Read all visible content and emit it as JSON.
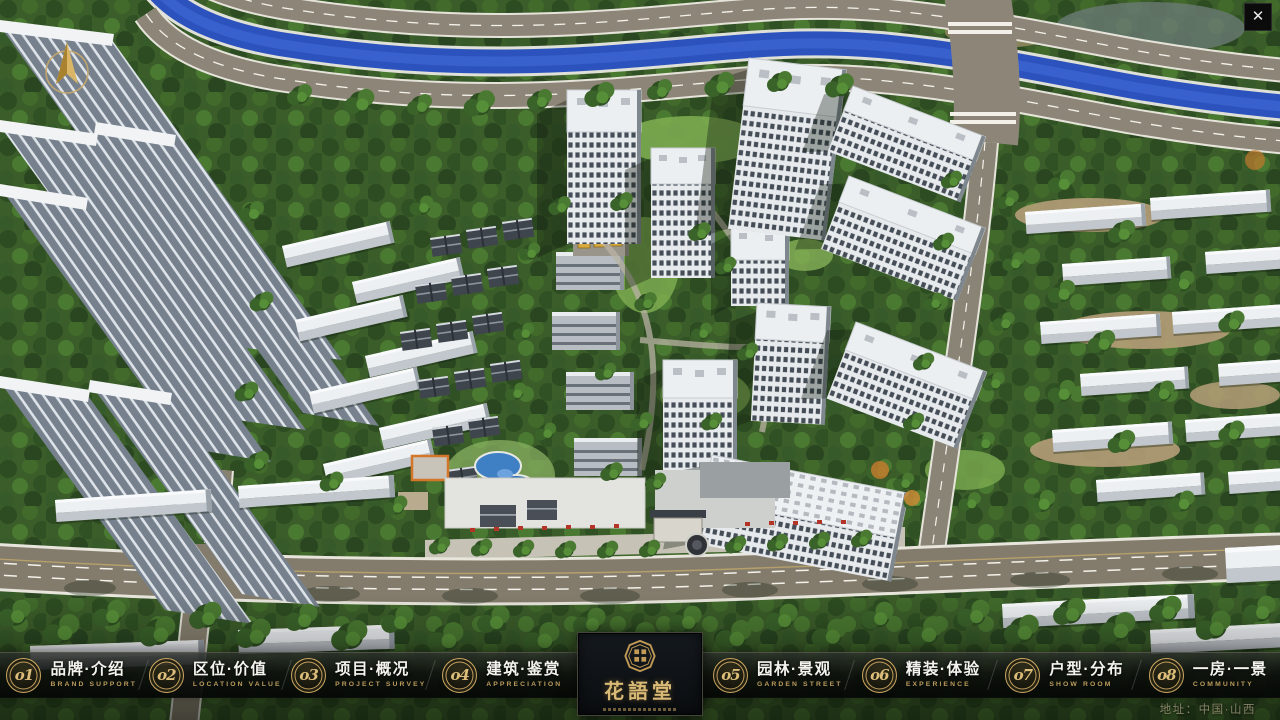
{
  "window": {
    "close": "✕"
  },
  "navbar": {
    "items": [
      {
        "number": "o1",
        "label": "品牌·介绍",
        "caption": "BRAND SUPPORT"
      },
      {
        "number": "o2",
        "label": "区位·价值",
        "caption": "LOCATION VALUE"
      },
      {
        "number": "o3",
        "label": "项目·概况",
        "caption": "PROJECT SURVEY"
      },
      {
        "number": "o4",
        "label": "建筑·鉴赏",
        "caption": "APPRECIATION"
      },
      {
        "number": "o5",
        "label": "园林·景观",
        "caption": "GARDEN STREET"
      },
      {
        "number": "o6",
        "label": "精装·体验",
        "caption": "EXPERIENCE"
      },
      {
        "number": "o7",
        "label": "户型·分布",
        "caption": "SHOW ROOM"
      },
      {
        "number": "o8",
        "label": "一房·一景",
        "caption": "COMMUNITY"
      }
    ]
  },
  "logo": {
    "title": "花語堂"
  },
  "footer": {
    "address": "地址：中国·山西"
  },
  "colors": {
    "gold": "#c8a463",
    "river": "#2c53bd",
    "bar_bg": "rgba(10,13,10,0.85)"
  }
}
